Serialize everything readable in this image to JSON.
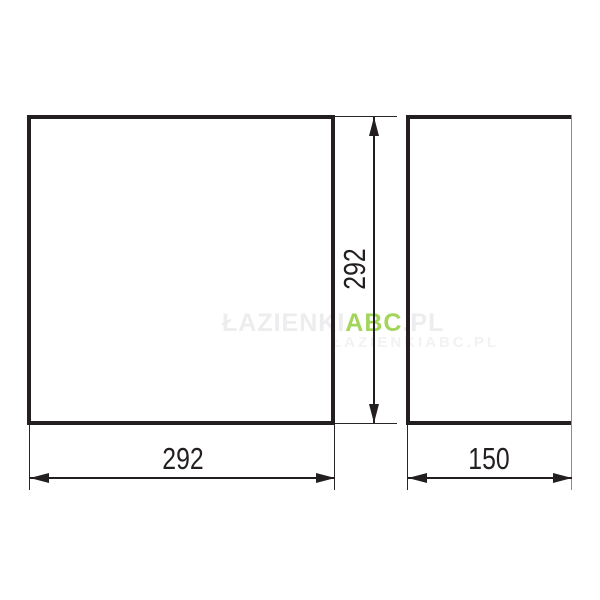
{
  "drawing": {
    "type": "technical-dimension-drawing",
    "front_view": {
      "height_label": "292",
      "width_label": "292"
    },
    "side_view": {
      "width_label": "150"
    },
    "dimensions": {
      "front_width": 292,
      "front_height": 292,
      "side_depth": 150
    }
  },
  "watermark": {
    "line1_prefix": "ŁAZIENKI",
    "line1_brand": "ABC",
    "line1_suffix": ".PL",
    "line2": "ŁAZIENKIABC.PL"
  },
  "colors": {
    "line": "#231f20",
    "brand_green": "#a3d55b",
    "watermark_gray": "#edecee",
    "side_right_edge_gray": "#8c8c8c",
    "background": "#ffffff"
  }
}
